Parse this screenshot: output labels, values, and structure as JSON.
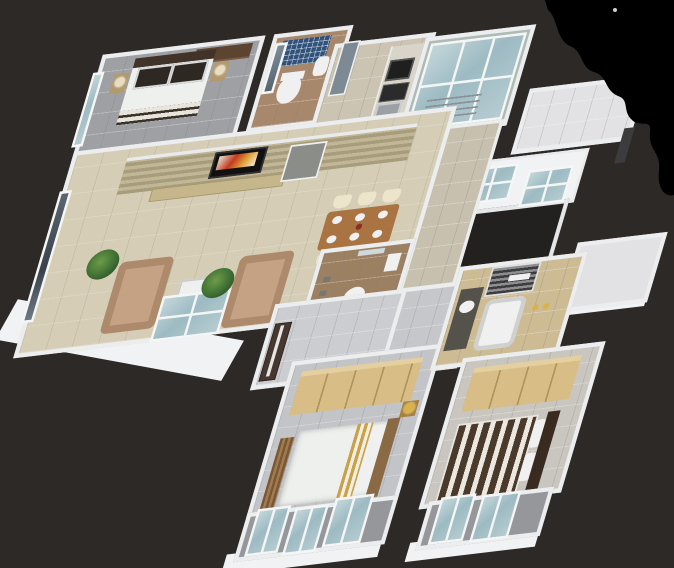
{
  "scene": {
    "type": "3d-isometric-floor-plan-render",
    "description": "Photorealistic 3D cutaway floor plan of a three-bedroom apartment viewed from above at an angle, on a dark charcoal backdrop with a black artifact blob in the top-right corner",
    "background": "#2c2927",
    "artifact": "black-blob-top-right"
  },
  "colors": {
    "background": "#2c2927",
    "blob": "#000000",
    "wall": "#ecedee",
    "wall_face": "#f1f2f4",
    "glass": "#a9c4ca",
    "glass_dark": "#454f58",
    "panel_gray": "#7d8a94",
    "door_gray": "#8b8e88",
    "floor_guest": "#9fa0a4",
    "floor_bath1": "#a8886c",
    "floor_kitchen": "#cbc4b2",
    "floor_utility": "#aebab4",
    "floor_east": "#e2e2e4",
    "floor_living": "#d5cdb6",
    "floor_passage": "#c7c0ae",
    "floor_corridor": "#c6c7ca",
    "floor_foyer": "#cccdd0",
    "floor_bath2": "#9c8062",
    "floor_bedroom2": "#c3c4c7",
    "floor_master": "#c9c6bf",
    "floor_master_bath": "#cdbb94",
    "floor_balcony": "#96979b",
    "void": "#232120",
    "mosaic_blue": "#31527a",
    "wood_table": "#aa7442",
    "wardrobe_tan": "#d9bd86",
    "sofa_beige": "#c5a284",
    "plant_green": "#3f6f33",
    "counter_orange": "#cf6a4a",
    "entry_door_brown": "#463731",
    "headboard_dark": "#3a2b20",
    "headboard_wood": "#8a6a44",
    "lamp_gold": "#d8b348",
    "tv_wall_wood": "#b0a47e",
    "console_wood": "#c6b68b",
    "chair_cream": "#ece4cb",
    "duvet_white": "#eef0ee",
    "counter_dark": "#55514b",
    "appliance_black": "#1f1f1f",
    "sink_gray": "#9aa0a3",
    "pillow_dark": "#2e2823"
  },
  "rooms": [
    {
      "id": "guest-bedroom",
      "contents": "double bed, two nightstands with lamps, wardrobe, window"
    },
    {
      "id": "bathroom-1",
      "contents": "blue mosaic shower wall, toilet, washbasin, glass partition"
    },
    {
      "id": "kitchen",
      "contents": "counter with hob and sink, orange counter section, tall panel"
    },
    {
      "id": "utility-glass-balcony",
      "contents": "full glazed enclosure, drying rack"
    },
    {
      "id": "east-service-wing",
      "contents": "white walls, two windows, duct void, white terrace room"
    },
    {
      "id": "living-room",
      "contents": "wood TV wall, TV, console, two sofas, glass coffee table, plants"
    },
    {
      "id": "dining-area",
      "contents": "wooden six-seater table, cream chairs, plates"
    },
    {
      "id": "bathroom-2",
      "contents": "pedestal washbasin, shelf, fittings"
    },
    {
      "id": "foyer",
      "contents": "dark brown entry door"
    },
    {
      "id": "bedroom-2",
      "contents": "tan wardrobe, bed with gold runner, wooden mat, gold lamp"
    },
    {
      "id": "master-bathroom",
      "contents": "dark counter with basin, tub, louver vent, gold fittings"
    },
    {
      "id": "master-bedroom",
      "contents": "tan wardrobe, striped brown bed, dark headboard"
    },
    {
      "id": "balconies",
      "contents": "framed glass railing panels"
    }
  ]
}
